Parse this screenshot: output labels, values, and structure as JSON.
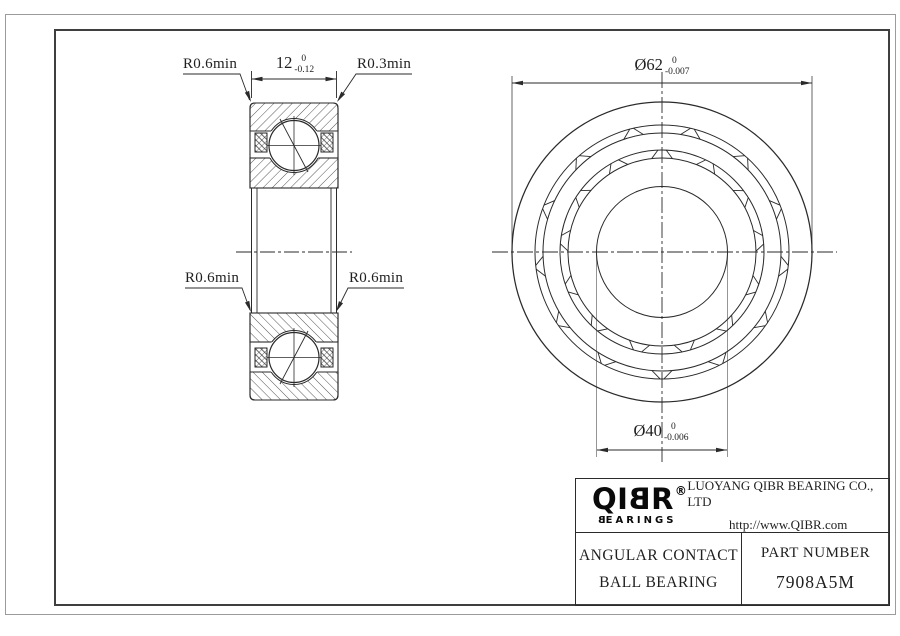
{
  "colors": {
    "line": "#2a2a2a",
    "frame": "#9c9c9c",
    "border": "#3f3f3f",
    "ext_line": "#8a8a8a"
  },
  "labels": {
    "fillet_top_left": "R0.6min",
    "fillet_top_right": "R0.3min",
    "fillet_mid_left": "R0.6min",
    "fillet_mid_right": "R0.6min"
  },
  "dimensions": {
    "width": {
      "nominal": "12",
      "tol_upper": "0",
      "tol_lower": "-0.12"
    },
    "outer_diameter": {
      "nominal": "Ø62",
      "tol_upper": "0",
      "tol_lower": "-0.007"
    },
    "bore_diameter": {
      "nominal": "Ø40",
      "tol_upper": "0",
      "tol_lower": "-0.006"
    }
  },
  "title_block": {
    "logo_q": "Q",
    "logo_i": "I",
    "logo_b": "B",
    "logo_r": "R",
    "logo_reg": "®",
    "logo_sub_b": "B",
    "logo_sub_rest": "EARINGS",
    "company": "LUOYANG QIBR BEARING CO., LTD",
    "website": "http://www.QIBR.com",
    "product_name_line1": "ANGULAR CONTACT",
    "product_name_line2": "BALL BEARING",
    "part_number_label": "PART NUMBER",
    "part_number": "7908A5M"
  },
  "geometry": {
    "front_view": {
      "cx": 662,
      "cy": 252,
      "radii": [
        150,
        127,
        119,
        102,
        94,
        65.5
      ],
      "pockets": [
        {
          "r_in": 119,
          "r_out": 127,
          "count": 13,
          "offset_deg": 90,
          "half_width_deg": 9,
          "flare_deg": 4
        },
        {
          "r_in": 94,
          "r_out": 102,
          "count": 13,
          "offset_deg": 103.8,
          "half_width_deg": 7.5,
          "flare_deg": 4
        }
      ]
    },
    "arrows": [
      {
        "x": 512,
        "y": 83,
        "deg": 180
      },
      {
        "x": 812,
        "y": 83,
        "deg": 0
      },
      {
        "x": 597,
        "y": 450,
        "deg": 180
      },
      {
        "x": 727,
        "y": 450,
        "deg": 0
      },
      {
        "x": 251.5,
        "y": 79,
        "deg": 180
      },
      {
        "x": 336.5,
        "y": 79,
        "deg": 0
      },
      {
        "x": 251,
        "y": 102,
        "deg": 68.5
      },
      {
        "x": 337,
        "y": 102,
        "deg": 124
      },
      {
        "x": 251,
        "y": 312,
        "deg": 69.4
      },
      {
        "x": 336,
        "y": 312,
        "deg": 117
      }
    ]
  }
}
